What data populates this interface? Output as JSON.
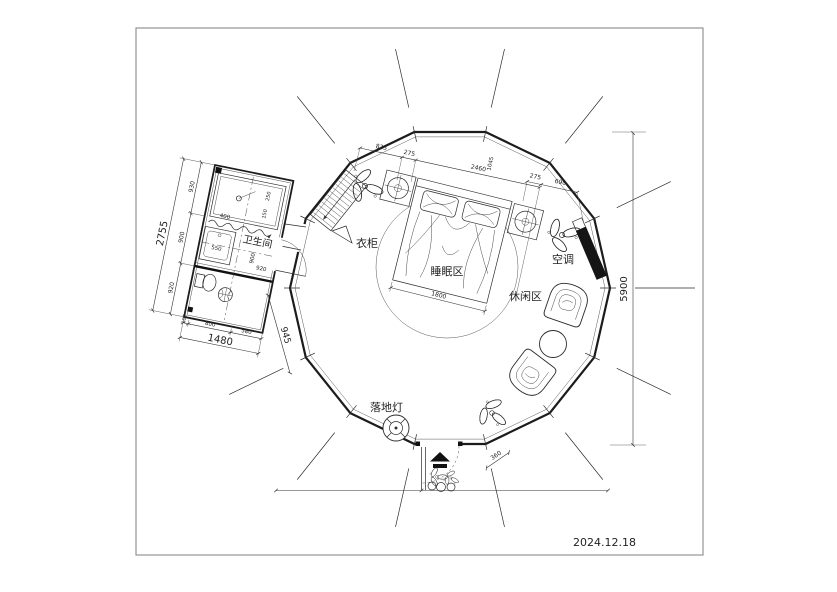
{
  "doc": {
    "date": "2024.12.18"
  },
  "labels": {
    "bathroom": "卫生间",
    "wardrobe": "衣柜",
    "sleeping": "睡眠区",
    "leisure": "休闲区",
    "ac": "空调",
    "lamp": "落地灯"
  },
  "dims": {
    "top": [
      "835",
      "275",
      "2460",
      "275",
      "690"
    ],
    "top_v": "1045",
    "overall_h": "5900",
    "bed_w": "1800",
    "door_w": "360",
    "bath_left_total": "2755",
    "bath_left": [
      "930",
      "900",
      "920"
    ],
    "bath_bottom": [
      "100",
      "800",
      "580"
    ],
    "bath_bottom_total": "1480",
    "bath_diag": "945",
    "bath_inner": [
      "400",
      "250",
      "150",
      "550",
      "900",
      "920"
    ]
  }
}
